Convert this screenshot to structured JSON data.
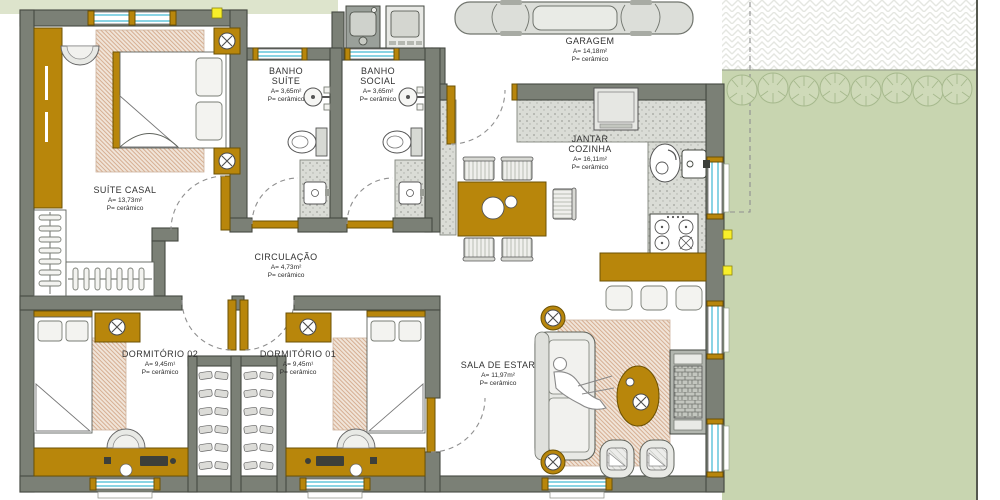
{
  "plan_title": "residential floor plan",
  "rooms": [
    {
      "id": "suite-casal",
      "name": "SUÍTE CASAL",
      "area": "A=  13,73m²",
      "floor": "P= cerâmico"
    },
    {
      "id": "banho-suite",
      "name": "BANHO\nSUÍTE",
      "area": "A=  3,65m²",
      "floor": "P= cerâmico"
    },
    {
      "id": "banho-social",
      "name": "BANHO\nSOCIAL",
      "area": "A=  3,65m²",
      "floor": "P= cerâmico"
    },
    {
      "id": "garagem",
      "name": "GARAGEM",
      "area": "A=  14,18m²",
      "floor": "P= cerâmico"
    },
    {
      "id": "jantar-cozinha",
      "name": "JANTAR\nCOZINHA",
      "area": "A=  16,11m²",
      "floor": "P= cerâmico"
    },
    {
      "id": "circulacao",
      "name": "CIRCULAÇÃO",
      "area": "A=  4,73m²",
      "floor": "P= cerâmico"
    },
    {
      "id": "dormitorio-02",
      "name": "DORMITÓRIO 02",
      "area": "A=  9,45m¹",
      "floor": "P= cerâmico"
    },
    {
      "id": "dormitorio-01",
      "name": "DORMITÓRIO 01",
      "area": "A=  9,45m¹",
      "floor": "P= cerâmico"
    },
    {
      "id": "sala-de-estar",
      "name": "SALA DE ESTAR",
      "area": "A=  11,97m²",
      "floor": "P= cerâmico"
    }
  ],
  "icons": {
    "plant_lamp_marker": "x-in-circle",
    "window_symbol": "double-cyan-line",
    "door_symbol": "gold-leaf-with-dashed-arc"
  },
  "colors": {
    "wall": "#7b8076",
    "wood": "#b8860b",
    "grass": "#c8d5b0",
    "grass_light": "#dde4cc",
    "window": "#8ad4e4",
    "outlet": "#f8ef2a",
    "counter": "#dadcd6"
  }
}
